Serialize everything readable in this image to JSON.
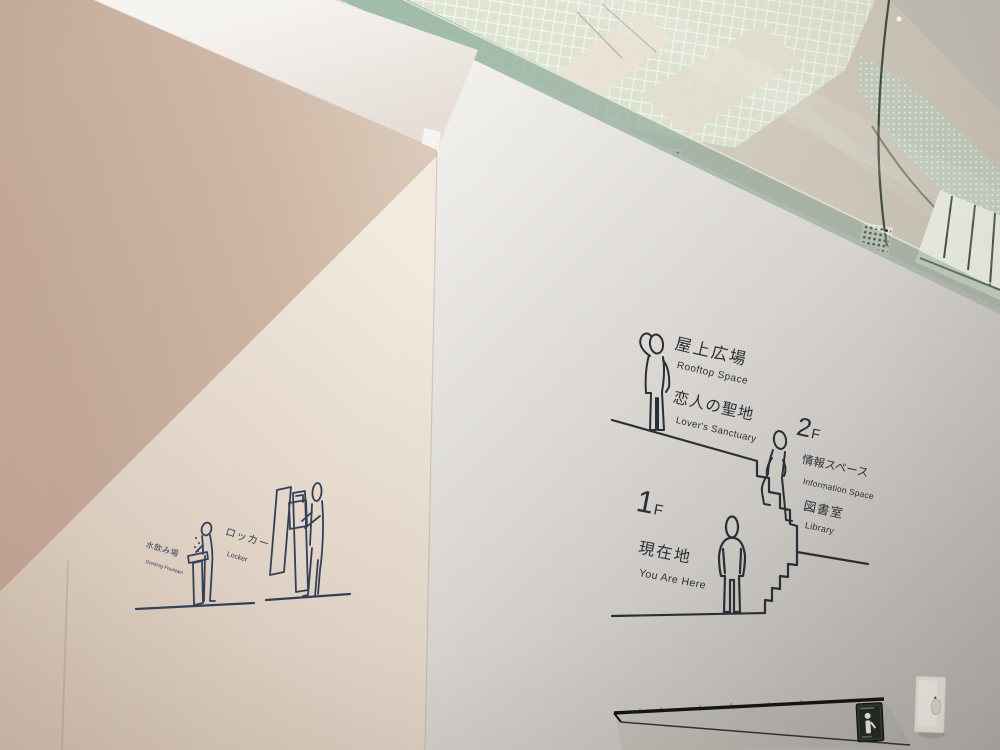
{
  "floor_guide": {
    "rooftop_jp": "屋上広場",
    "rooftop_en": "Rooftop Space",
    "sanctuary_jp": "恋人の聖地",
    "sanctuary_en": "Lover's Sanctuary",
    "floor2_num": "2",
    "floor2_suffix": "F",
    "info_jp": "情報スペース",
    "info_en": "Information Space",
    "library_jp": "図書室",
    "library_en": "Library",
    "floor1_num": "1",
    "floor1_suffix": "F",
    "here_jp": "現在地",
    "here_en": "You Are Here"
  },
  "amenity_signs": {
    "fountain_jp": "水飲み場",
    "fountain_en": "Drinking Fountain",
    "locker_jp": "ロッカー",
    "locker_en": "Locker"
  },
  "pictograms": {
    "rooftop_person": "person-shading-eyes-icon",
    "climbing_person": "person-climbing-stairs-icon",
    "standing_person": "person-standing-icon",
    "stairs": "stairs-profile-icon",
    "fountain": "drinking-fountain-icon",
    "locker": "locker-loading-icon",
    "info_sign": "information-sign-icon"
  },
  "colors": {
    "wall_bright": "#f3f1ee",
    "wall_dark": "#bab7b2",
    "soffit_shadow": "#c4a997",
    "line_art": "#2a2f36",
    "line_art_navy": "#33405a",
    "glass_tint": "#9bb9a8",
    "info_sign_bg": "#20261f"
  }
}
